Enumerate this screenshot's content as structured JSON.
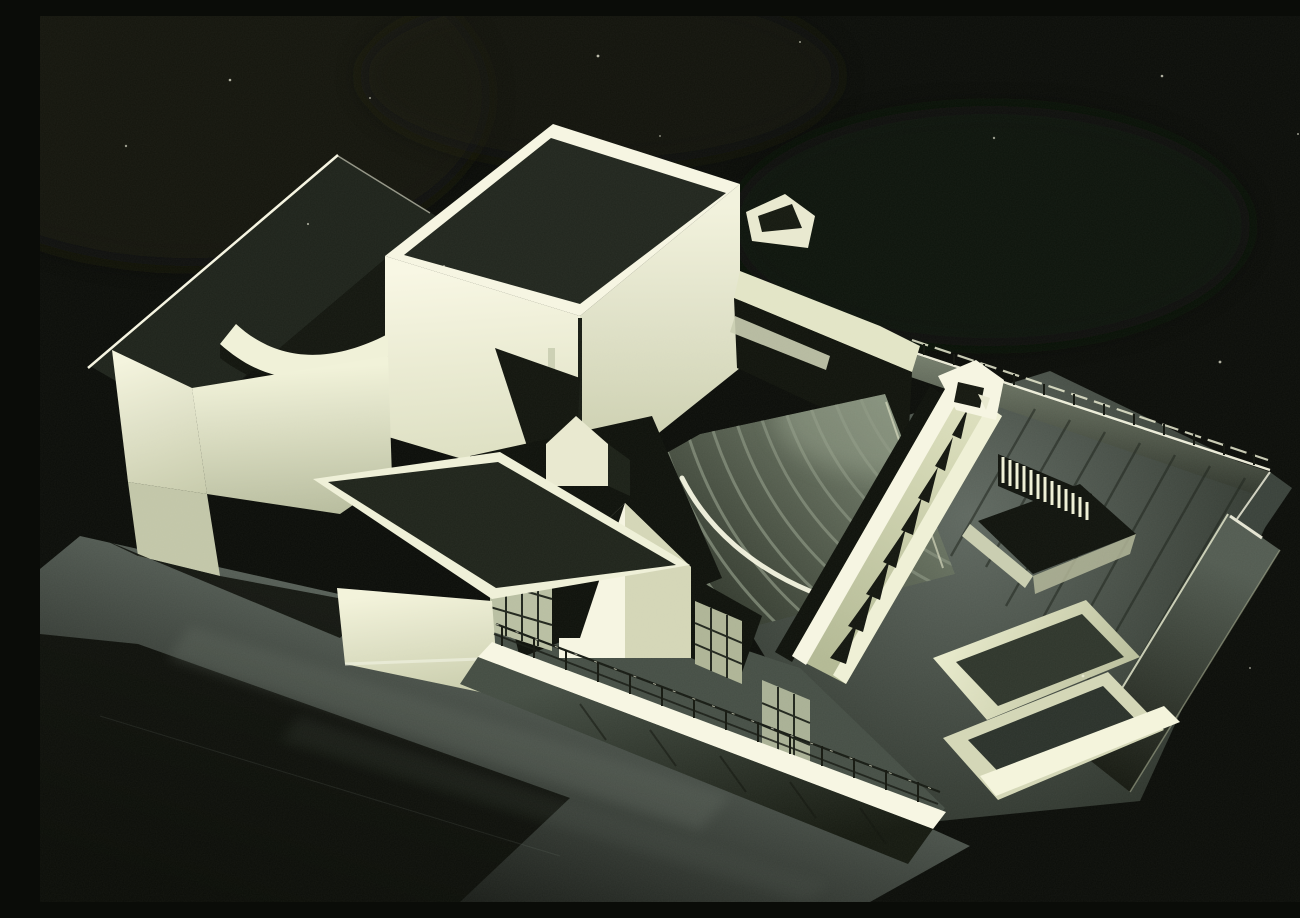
{
  "meta": {
    "title": "Architectural model photograph",
    "alt": "High-contrast black-and-white photograph of a white architectural scale model of a theatre complex, lit from the left against a black background"
  },
  "photo": {
    "medium": "black-and-white photograph (printed halftone)",
    "subject": "scale model of a modernist theatre / opera-house complex on a dark table",
    "lighting": "single strong light from the left; white volumes glow against a near-black field",
    "elements": [
      {
        "name": "long-workshop-wing",
        "note": "low bar building upper left with dark roof and lit end wall"
      },
      {
        "name": "curved-roof-band",
        "note": "concave curved white roof section in the middle of the wing"
      },
      {
        "name": "fly-tower",
        "note": "large cube at top center, dark roof, two lit faces split by a vertical slot"
      },
      {
        "name": "roof-fin",
        "note": "triangular wall fin rising at the tower's right corner"
      },
      {
        "name": "auditorium-fan-roof",
        "note": "fan-shaped stepped roof with concentric curved ridges"
      },
      {
        "name": "skylight-gallery",
        "note": "long diagonal roof strip with a row of dark wedge skylights"
      },
      {
        "name": "slatted-courtyard",
        "note": "sunken court with a screen of thin vertical slats"
      },
      {
        "name": "perimeter-wall-railing",
        "note": "site wall with thin wire railing casting diagonal shadows"
      },
      {
        "name": "front-terrace-railing",
        "note": "bright parapet band with wire railing across the front"
      },
      {
        "name": "gabled-pavilions",
        "note": "small white pitched-roof volumes and mullioned glazing at center front"
      },
      {
        "name": "annex-block",
        "note": "low flat dark-roofed block at lower left"
      },
      {
        "name": "table-surface",
        "note": "dark tabletop with soft light streaks in the foreground"
      }
    ],
    "palette": {
      "background": "#0a0c08",
      "ivory_highlight": "#f6f5e2",
      "ivory_mid": "#e9e9d0",
      "ivory_shaded": "#c9cdb0",
      "roof_shadow": "#21251c",
      "deep_shadow": "#0e110b",
      "fan_ridge_gray": "#828c7a",
      "terrace_gray": "#5d665c",
      "table_gray": "#4c554d"
    }
  }
}
